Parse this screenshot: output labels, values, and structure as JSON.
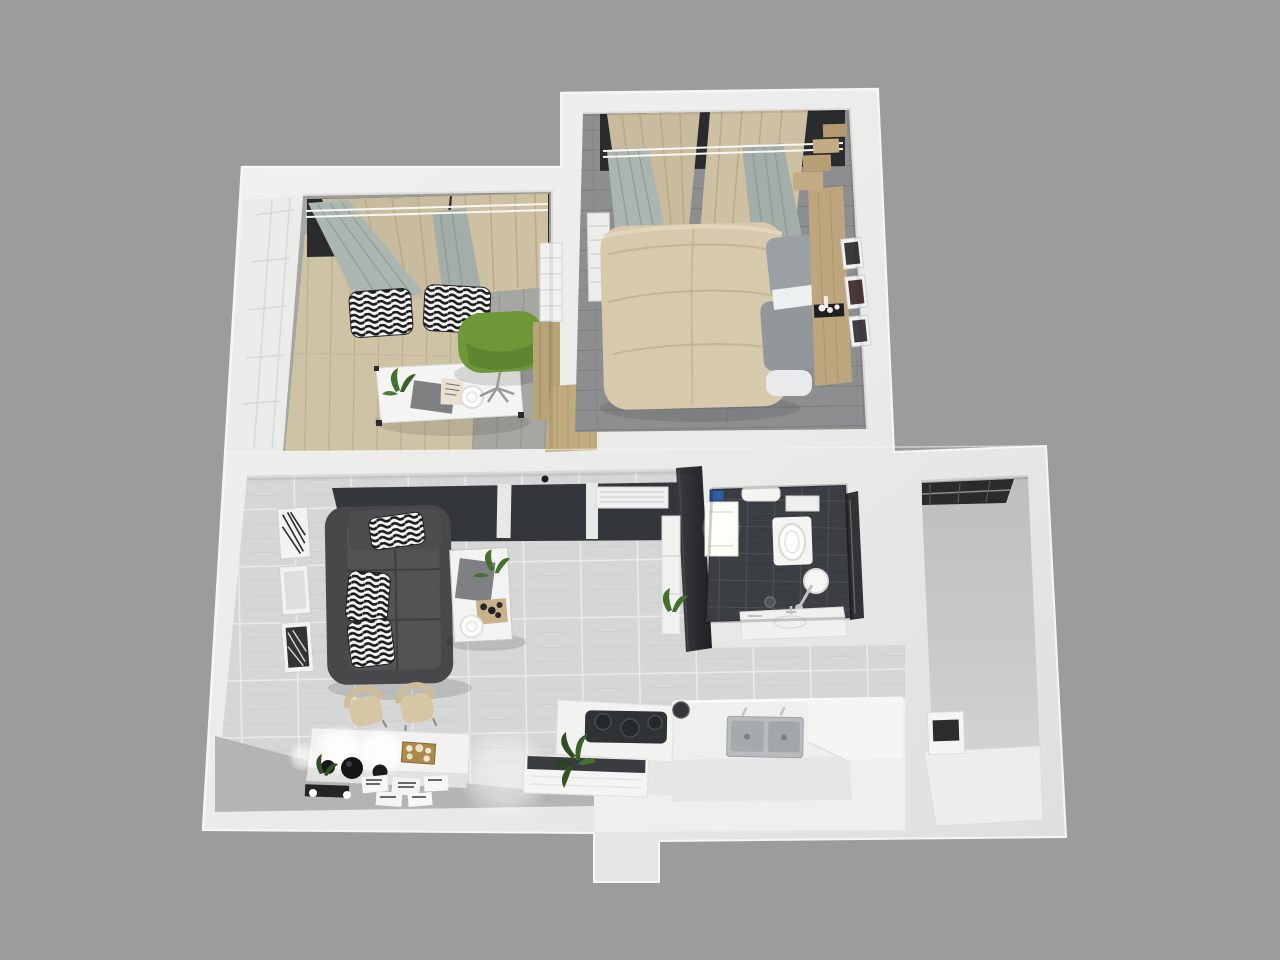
{
  "scene": {
    "type": "3d-floorplan-render",
    "description": "Top-down 3D render of a one-bedroom apartment with office, bedroom, living room, bathroom, kitchen and utility balcony",
    "width": 1280,
    "height": 960
  },
  "palette": {
    "background": "#9c9c9c",
    "wallLight": "#eaeae8",
    "wallTop": "#f5f5f3",
    "wallShadow": "#d7d7d5",
    "officeFloorGray": "#a6a6a3",
    "officeRug": "#cfc3a5",
    "bedroomFloor": "#8d8e90",
    "tileBase": "#d4d7d6",
    "tileGrout": "#e9ebea",
    "bathTile": "#3a3d42",
    "bathGrout": "#53565c",
    "zebraWhite": "#f5f5f3",
    "zebraBlack": "#1c1c1e",
    "curtainBeige": "#c9bb9d",
    "curtainBeige2": "#cec0a2",
    "curtainSage": "#aab6af",
    "curtainSage2": "#a2aea7",
    "windowDark": "#292b2d",
    "wardrobeFace": "#ebebe9",
    "bookshelf": "#f1f1ef",
    "woodCabinet": "#b7a478",
    "doorwayWood": "#c0ab7f",
    "deskWhite": "#f4f4f2",
    "chairGreen": "#6e9738",
    "bedDuvet": "#d6c9ac",
    "pillowGray": "#9aa0a4",
    "pillowGray2": "#91979b",
    "sheetWhite": "#edf0f1",
    "headboardWood": "#bda67e",
    "stepWood": "#c3ac84",
    "stepWood2": "#b49a6e",
    "radiator": "#ecedeb",
    "frameWhite": "#f2f2f0",
    "frameArt": "#3a3a3c",
    "darkPanel": "#33363a",
    "tvWall": "#2b2d30",
    "vent": "#f0f0ee",
    "sofaBody": "#48484b",
    "sofaSeat": "#535356",
    "tableWhite": "#f3f3f1",
    "clothGray": "#7e8082",
    "plantGreen": "#45702f",
    "plantDark": "#2f4d22",
    "trayWood": "#c9b289",
    "chairBeige": "#d6c6a4",
    "consoleWhite": "#f2f2f0",
    "goldBox": "#ad8a4a",
    "vaseBlack": "#17181a",
    "matBlack": "#232426",
    "cardWhite": "#f6f6f4",
    "entryFloor": "#b2b2b0",
    "fixtureWhite": "#f4f4f2",
    "glassDark": "#232529",
    "blueBox": "#2f5e9e",
    "chrome": "#c0c3c6",
    "counterWhite": "#efefed",
    "counterShade": "#e3e3e1",
    "cooktop": "#303336",
    "steel": "#b9bcbe",
    "steelBasin": "#a7aaac",
    "balconyFloor": "#c8c8c6",
    "applianceDoor": "#2a2c2e"
  },
  "rooms": [
    {
      "id": "office",
      "label": "office-study",
      "furniture": [
        "wardrobe",
        "curtains",
        "zebra-pillows",
        "desk",
        "green-office-chair",
        "bookshelf",
        "wood-cabinet"
      ]
    },
    {
      "id": "bedroom",
      "label": "bedroom",
      "furniture": [
        "double-bed",
        "gray-pillows",
        "wood-headboard",
        "curtains",
        "radiator",
        "picture-frames",
        "stepped-dresser"
      ]
    },
    {
      "id": "living-room",
      "label": "living-room",
      "furniture": [
        "dark-sofa",
        "zebra-cushions",
        "coffee-table",
        "picture-frames",
        "two-beige-chairs",
        "console-with-lamps",
        "tv-wall",
        "plant-shelf"
      ]
    },
    {
      "id": "bathroom",
      "label": "bathroom",
      "furniture": [
        "washing-machine",
        "toilet",
        "shower",
        "glass-screen",
        "towel",
        "sink-counter"
      ]
    },
    {
      "id": "kitchen",
      "label": "kitchen",
      "furniture": [
        "cooktop-island",
        "double-steel-sink",
        "counter",
        "floor-mat",
        "plant"
      ]
    },
    {
      "id": "balcony",
      "label": "utility-balcony",
      "furniture": [
        "window",
        "appliance",
        "counter"
      ]
    }
  ]
}
